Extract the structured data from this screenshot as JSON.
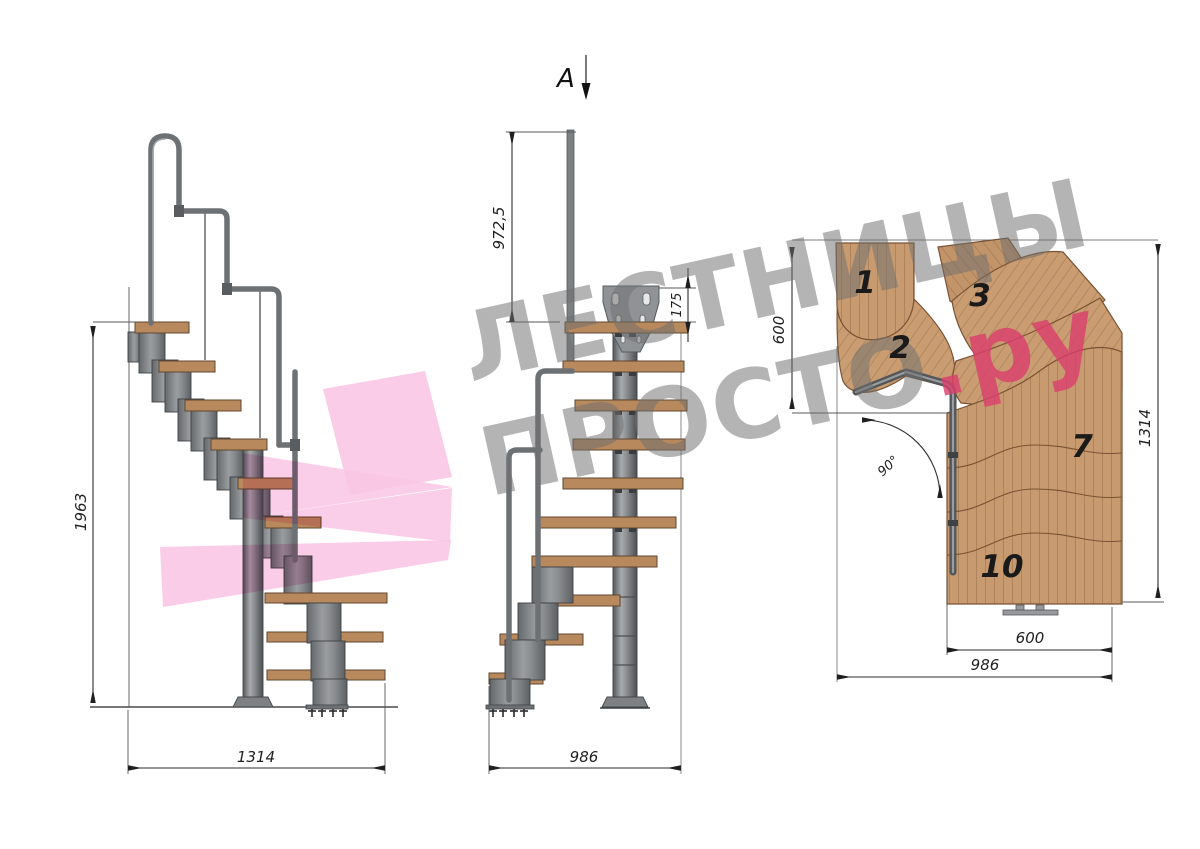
{
  "watermark": {
    "line1": "ЛЕСТНИЦЫ",
    "line2": "ПРОСТО",
    "line2_suffix": ".ру",
    "gray_color": "#707070",
    "pink_color": "#DB3E6E",
    "logo_pink": "#F9C6E4"
  },
  "views": {
    "side": {
      "title": "side-view",
      "dims": {
        "height": "1963",
        "run": "1314"
      }
    },
    "front": {
      "title": "front-view",
      "section_label": "A",
      "dims": {
        "rail_height": "972,5",
        "plate_height": "175",
        "width": "986"
      }
    },
    "plan": {
      "title": "plan-view",
      "angle": "90°",
      "dims": {
        "entry_width": "600",
        "depth": "1314",
        "exit_width": "600",
        "width": "986"
      },
      "step_labels": [
        "1",
        "2",
        "3",
        "7",
        "10"
      ]
    }
  }
}
